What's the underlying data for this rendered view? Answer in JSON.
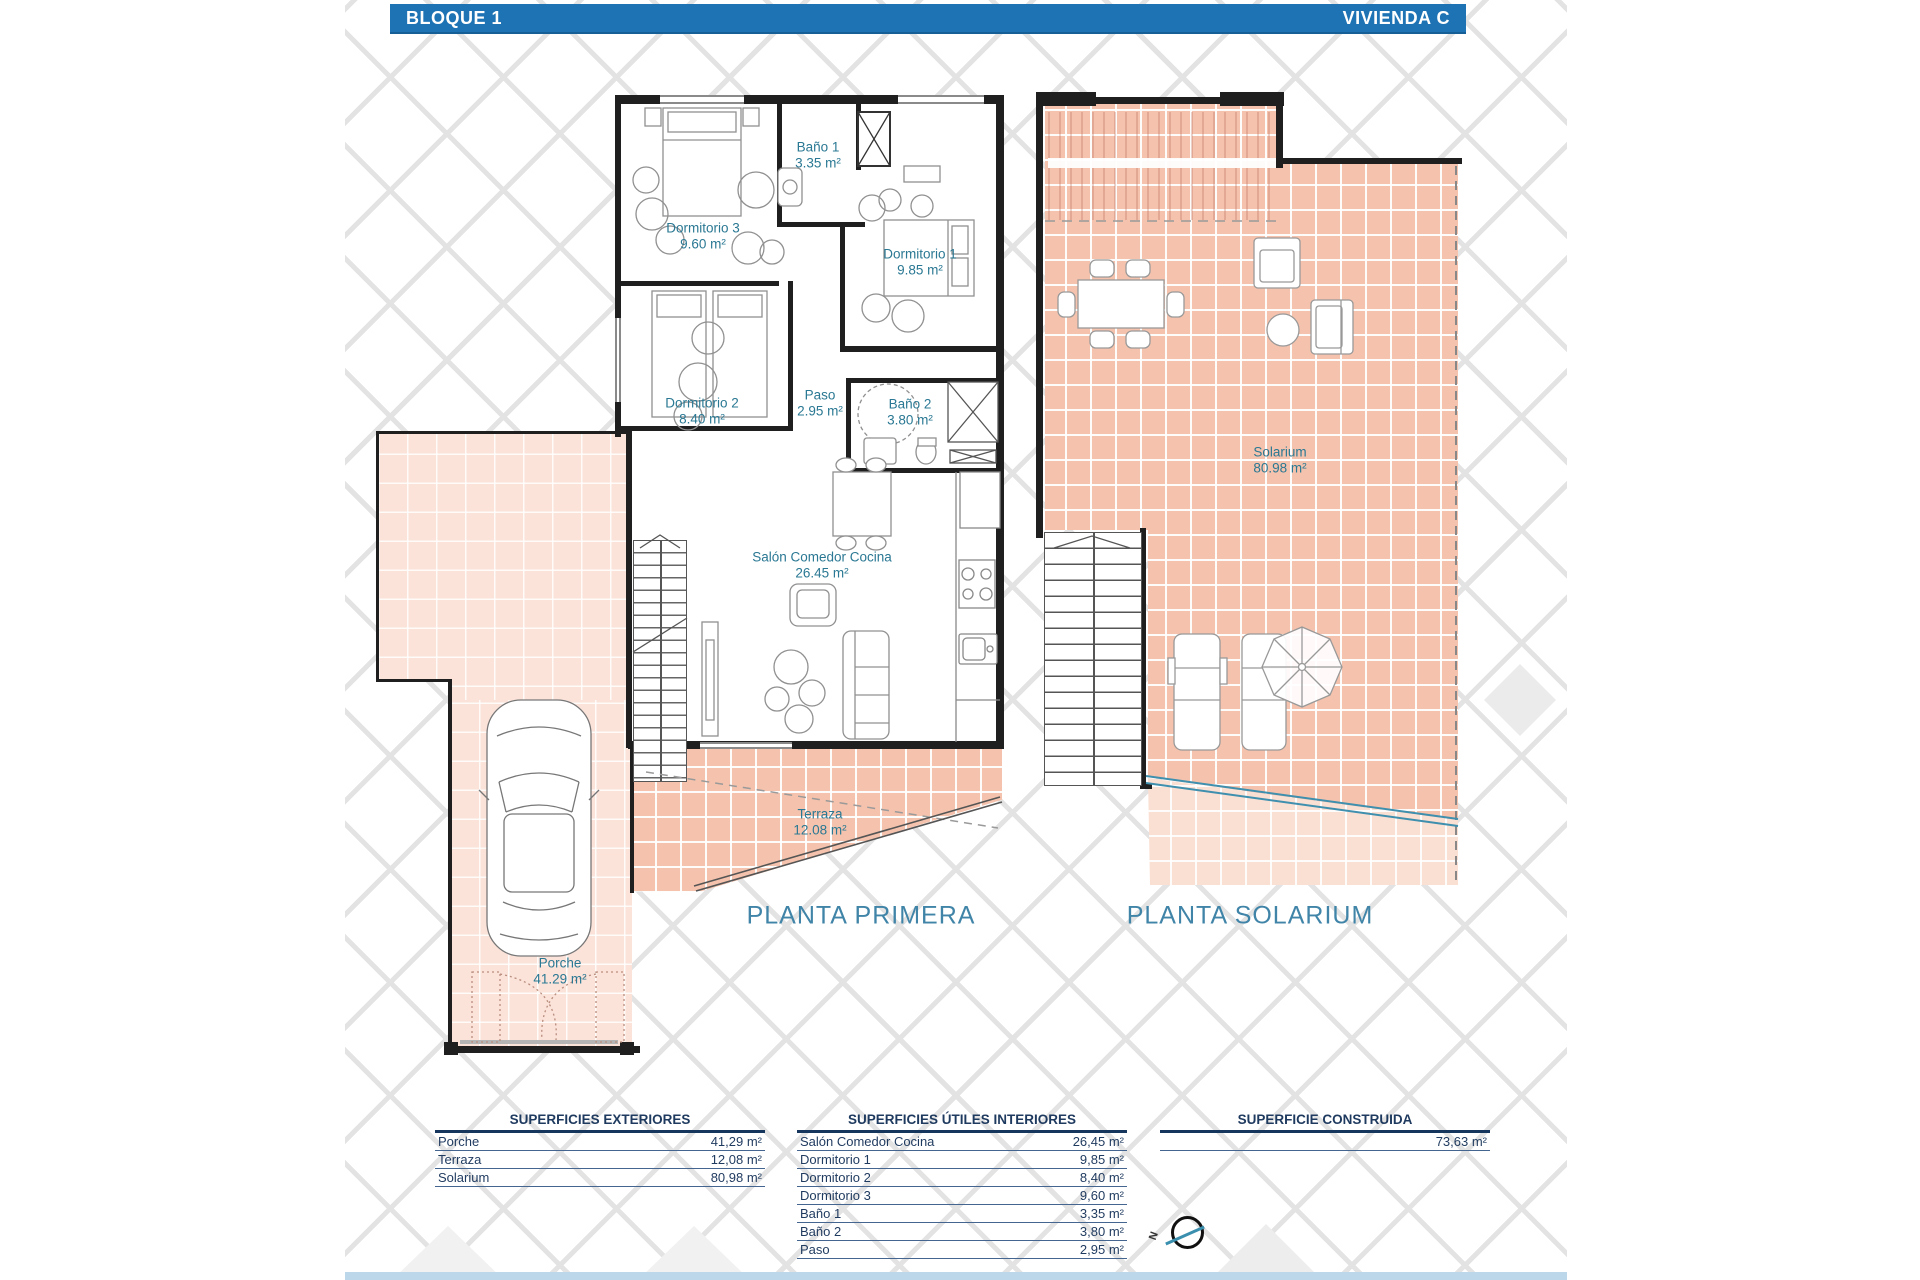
{
  "header": {
    "block": "BLOQUE 1",
    "unit": "VIVIENDA C"
  },
  "floors": {
    "primera": {
      "title": "PLANTA PRIMERA",
      "rooms": {
        "banio1": {
          "name": "Baño 1",
          "area": "3.35 m²"
        },
        "dorm3": {
          "name": "Dormitorio 3",
          "area": "9.60 m²"
        },
        "dorm1": {
          "name": "Dormitorio 1",
          "area": "9.85 m²"
        },
        "dorm2": {
          "name": "Dormitorio 2",
          "area": "8.40 m²"
        },
        "paso": {
          "name": "Paso",
          "area": "2.95 m²"
        },
        "banio2": {
          "name": "Baño 2",
          "area": "3.80 m²"
        },
        "salon": {
          "name": "Salón Comedor Cocina",
          "area": "26.45 m²"
        },
        "terraza": {
          "name": "Terraza",
          "area": "12.08 m²"
        },
        "porche": {
          "name": "Porche",
          "area": "41.29 m²"
        }
      }
    },
    "solarium": {
      "title": "PLANTA SOLARIUM",
      "rooms": {
        "solarium": {
          "name": "Solarium",
          "area": "80.98 m²"
        }
      }
    }
  },
  "tables": {
    "exteriores": {
      "title": "SUPERFICIES EXTERIORES",
      "rows": [
        {
          "label": "Porche",
          "value": "41,29 m²"
        },
        {
          "label": "Terraza",
          "value": "12,08 m²"
        },
        {
          "label": "Solarium",
          "value": "80,98 m²"
        }
      ]
    },
    "interiores": {
      "title": "SUPERFICIES ÚTILES INTERIORES",
      "rows": [
        {
          "label": "Salón Comedor Cocina",
          "value": "26,45 m²"
        },
        {
          "label": "Dormitorio 1",
          "value": "9,85 m²"
        },
        {
          "label": "Dormitorio 2",
          "value": "8,40 m²"
        },
        {
          "label": "Dormitorio 3",
          "value": "9,60 m²"
        },
        {
          "label": "Baño 1",
          "value": "3,35 m²"
        },
        {
          "label": "Baño 2",
          "value": "3,80 m²"
        },
        {
          "label": "Paso",
          "value": "2,95 m²"
        }
      ]
    },
    "construida": {
      "title": "SUPERFICIE CONSTRUIDA",
      "rows": [
        {
          "label": "",
          "value": "73,63 m²"
        }
      ]
    }
  },
  "compass": {
    "north": "N"
  },
  "colors": {
    "header_blue": "#1e73b4",
    "label_teal": "#2a7893",
    "title_blue": "#4084a8",
    "table_navy": "#1f3a5f",
    "tile_pink": "#f5c3ad",
    "tile_pink_light": "#fbe3da",
    "railing_teal": "#3f8fae",
    "footer_strip": "#bdd7ea"
  }
}
